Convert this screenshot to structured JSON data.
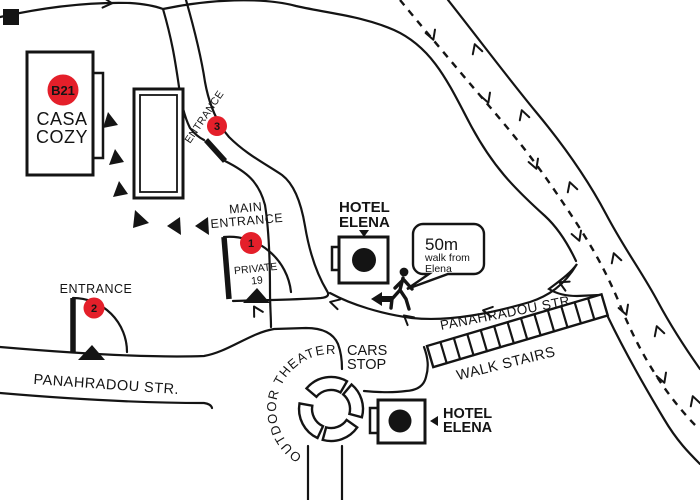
{
  "colors": {
    "red": "#e41f2a",
    "ink": "#141414"
  },
  "casa_cozy": {
    "badge": "B21",
    "name_line1": "CASA",
    "name_line2": "COZY"
  },
  "main_entrance": {
    "label_line1": "MAIN",
    "label_line2": "ENTRANCE",
    "number": "1",
    "private_line1": "PRIVATE",
    "private_line2": "19"
  },
  "entrance2": {
    "label": "ENTRANCE",
    "number": "2"
  },
  "entrance3": {
    "label": "ENTRANCE",
    "number": "3"
  },
  "hotel_elena_top": {
    "name_line1": "HOTEL",
    "name_line2": "ELENA",
    "symbol": "H"
  },
  "hotel_elena_bottom": {
    "name_line1": "HOTEL",
    "name_line2": "ELENA",
    "symbol": "H"
  },
  "callout": {
    "distance": "50m",
    "line2": "walk from",
    "line3": "Elena"
  },
  "streets": {
    "panahradou_left": "PANAHRADOU STR.",
    "panahradou_right": "PANAHRADOU STR.",
    "walk_stairs": "WALK STAIRS",
    "cars_stop_line1": "CARS",
    "cars_stop_line2": "STOP",
    "outdoor_theater": "OUTDOOR THEATER"
  }
}
